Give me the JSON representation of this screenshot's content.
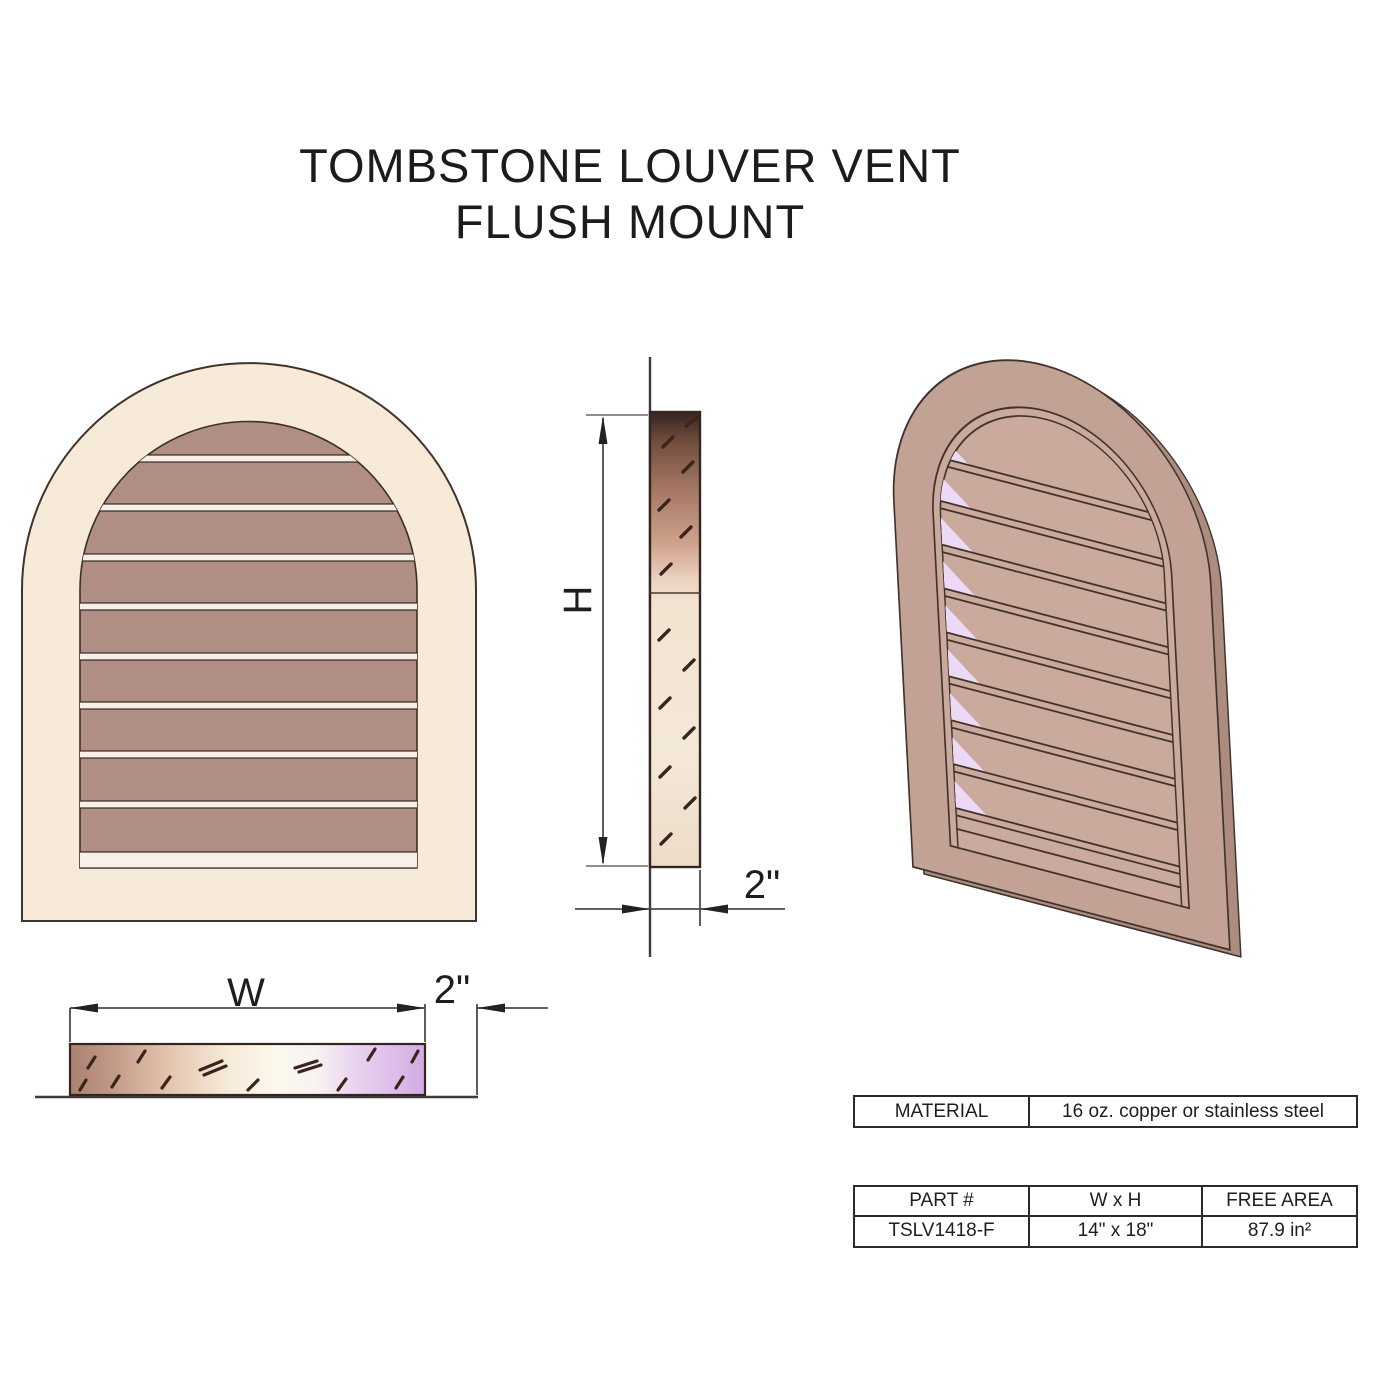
{
  "title": {
    "line1": "TOMBSTONE LOUVER VENT",
    "line2": "FLUSH MOUNT"
  },
  "dimensions": {
    "width_label": "W",
    "height_label": "H",
    "depth_label_side": "2\"",
    "depth_label_plan": "2\""
  },
  "material_table": {
    "label": "MATERIAL",
    "value": "16 oz. copper or stainless steel"
  },
  "spec_table": {
    "headers": [
      "PART #",
      "W x H",
      "FREE AREA"
    ],
    "row": [
      "TSLV1418-F",
      "14\" x 18\"",
      "87.9 in²"
    ]
  },
  "colors": {
    "frame_cream": "#f8ead9",
    "louver_brown": "#b18e83",
    "iso_frame": "#c2a294",
    "iso_slat": "#c9aa9c",
    "louver_gap_lavender": "#ecd9f6",
    "outline": "#3f332c"
  }
}
